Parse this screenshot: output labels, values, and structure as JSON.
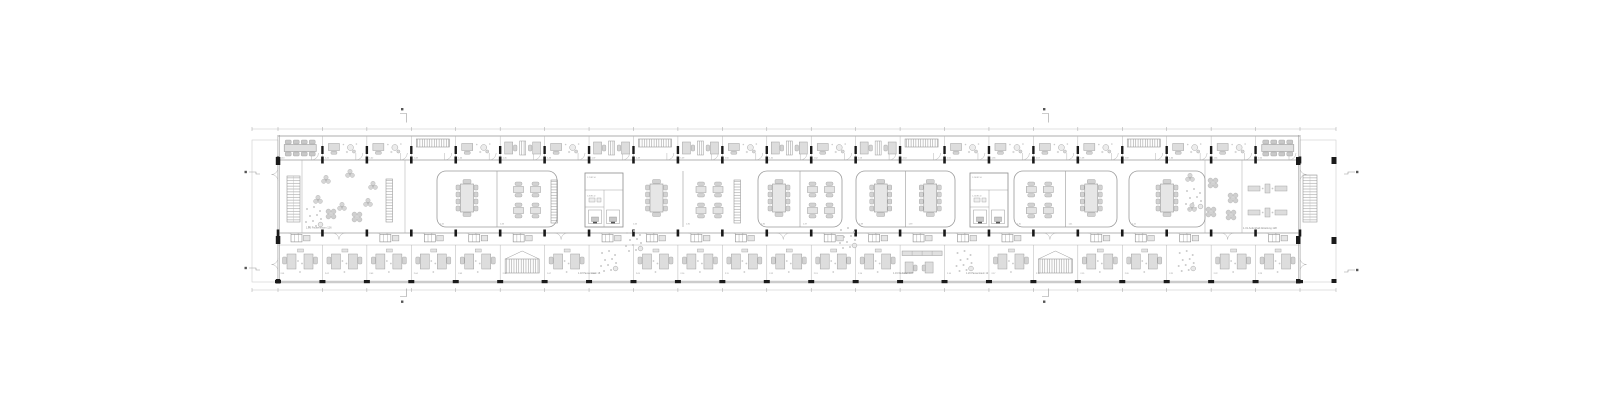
{
  "colors": {
    "wall": "#9a9a9a",
    "wall_light": "#b8b8b8",
    "furn_fill": "#e0e0e0",
    "furn_stroke": "#9f9f9f",
    "column": "#1a1a1a",
    "label": "#8a8a8a",
    "dim": "#c2c2c2",
    "marker": "#555555"
  },
  "plan": {
    "grid": {
      "x0": 278,
      "x1": 1300,
      "bays": 23,
      "yTop": 136,
      "yW1": 160,
      "yW2": 233,
      "yCor": 245,
      "yBot": 282
    },
    "porch": {
      "left_x": 252,
      "right_x": 1336,
      "y": 140,
      "h": 142
    },
    "dims": {
      "yTop": 129,
      "yBot": 290
    },
    "topRooms": [
      "meet8",
      "dpl",
      "dpl",
      "lock",
      "dpl",
      "dpair",
      "dpl",
      "dpair",
      "lock",
      "dpair",
      "dpl",
      "dpair",
      "dpl",
      "dpair",
      "lock",
      "dpl",
      "dpl",
      "dpl",
      "dpl",
      "lock",
      "dpl",
      "dpl",
      "meet8"
    ],
    "bottomRooms": [
      "opair",
      "opair",
      "opair",
      "opair",
      "opair",
      "bench",
      "opair",
      "dots",
      "opair",
      "opair",
      "opair",
      "opair",
      "opair",
      "opair",
      "trow",
      "dots",
      "opair",
      "bench",
      "opair",
      "opair",
      "dots",
      "opair",
      "opair"
    ],
    "topCodes": [
      "1.40",
      "1.41",
      "1.42",
      "1.43",
      "1.44",
      "1.45",
      "1.46",
      "1.47",
      "1.48",
      "1.49",
      "1.50",
      "1.51",
      "1.52",
      "1.53",
      "1.54",
      "1.55",
      "1.56",
      "1.57",
      "1.58",
      "1.59",
      "1.60",
      "1.61",
      "1.62"
    ],
    "bottomCodes": [
      "2.01",
      "2.02",
      "2.03",
      "2.04",
      "2.05",
      "2.06",
      "2.07",
      "2.08",
      "2.09",
      "2.10",
      "2.11",
      "2.12",
      "2.13",
      "2.14",
      "2.15",
      "2.16",
      "2.17",
      "2.18",
      "2.19",
      "2.20",
      "2.21",
      "2.22",
      "2.23"
    ],
    "middle": {
      "stairs": [
        {
          "x": 287,
          "y": 176,
          "w": 13,
          "h": 46
        },
        {
          "x": 1303,
          "y": 175,
          "w": 14,
          "h": 47
        }
      ],
      "partitions": [
        302,
        405,
        1205,
        1242
      ],
      "shelves": [
        {
          "x": 386,
          "y": 179
        },
        {
          "x": 551,
          "y": 180
        },
        {
          "x": 734,
          "y": 180
        }
      ],
      "envelopes": [
        {
          "x": 437,
          "w": 120,
          "kind": "round",
          "cells": [
            "conf",
            "quad"
          ],
          "codes": [
            "1.32",
            "1.33"
          ]
        },
        {
          "x": 630,
          "w": 106,
          "kind": "open",
          "cells": [
            "conf",
            "quad"
          ],
          "codes": [
            "1.34",
            "1.35"
          ]
        },
        {
          "x": 758,
          "w": 84,
          "kind": "round",
          "cells": [
            "conf",
            "quad"
          ],
          "codes": [
            "1.36",
            "1.37"
          ]
        },
        {
          "x": 856,
          "w": 99,
          "kind": "round",
          "cells": [
            "conf",
            "conf"
          ],
          "codes": [
            "1.38",
            "1.39"
          ]
        },
        {
          "x": 1014,
          "w": 103,
          "kind": "round",
          "cells": [
            "quad",
            "conf"
          ],
          "codes": [
            "1.40",
            "1.41"
          ]
        },
        {
          "x": 1129,
          "w": 76,
          "kind": "round",
          "cells": [
            "conf"
          ],
          "codes": [
            "1.42"
          ]
        }
      ],
      "wcCores": [
        {
          "x": 585,
          "y": 173,
          "labels": [
            "1.7 WC H",
            "1.8 WC D"
          ]
        },
        {
          "x": 970,
          "y": 173,
          "labels": [
            "1.24 WC H",
            "1.25 WC D"
          ]
        }
      ],
      "plantsTri": [
        [
          326,
          180
        ],
        [
          350,
          174
        ],
        [
          373,
          186
        ],
        [
          318,
          200
        ],
        [
          342,
          207
        ],
        [
          368,
          203
        ],
        [
          1190,
          178
        ],
        [
          1192,
          208
        ]
      ],
      "plantsX": [
        [
          331,
          214
        ],
        [
          357,
          217
        ],
        [
          1213,
          183
        ],
        [
          1233,
          198
        ],
        [
          1211,
          212
        ],
        [
          1231,
          215
        ]
      ],
      "dotClusters": [
        [
          304,
          206
        ],
        [
          624,
          230
        ],
        [
          838,
          227
        ],
        [
          1184,
          188
        ]
      ],
      "benchRows": [
        {
          "x": 1248,
          "y": 184
        },
        {
          "x": 1248,
          "y": 208
        }
      ]
    },
    "fixtures": [
      0,
      2,
      3,
      4,
      5,
      7,
      8,
      9,
      10,
      12,
      13,
      14,
      15,
      16,
      18,
      19,
      20,
      22
    ],
    "labels": [
      {
        "t": "1.16 Pausenraum 126",
        "x": 306,
        "y": 228.5,
        "s": 2.6
      },
      {
        "t": "1.18 Pausenraum 18",
        "x": 578,
        "y": 274,
        "s": 2.4
      },
      {
        "t": "1.19 Werkstatt 107",
        "x": 893,
        "y": 274,
        "s": 2.4
      },
      {
        "t": "1.20 Pausenraum 12",
        "x": 966,
        "y": 274,
        "s": 2.4
      },
      {
        "t": "1.31 Aufenthalt Abteilung 128",
        "x": 1243,
        "y": 229,
        "s": 2.6
      }
    ]
  },
  "markers": {
    "sections": [
      {
        "side": "top",
        "x": 400
      },
      {
        "side": "top",
        "x": 1042
      },
      {
        "side": "bottom",
        "x": 400
      },
      {
        "side": "bottom",
        "x": 1042
      },
      {
        "side": "left",
        "y": 172
      },
      {
        "side": "left",
        "y": 268
      },
      {
        "side": "right",
        "y": 172
      },
      {
        "side": "right",
        "y": 270
      }
    ]
  }
}
